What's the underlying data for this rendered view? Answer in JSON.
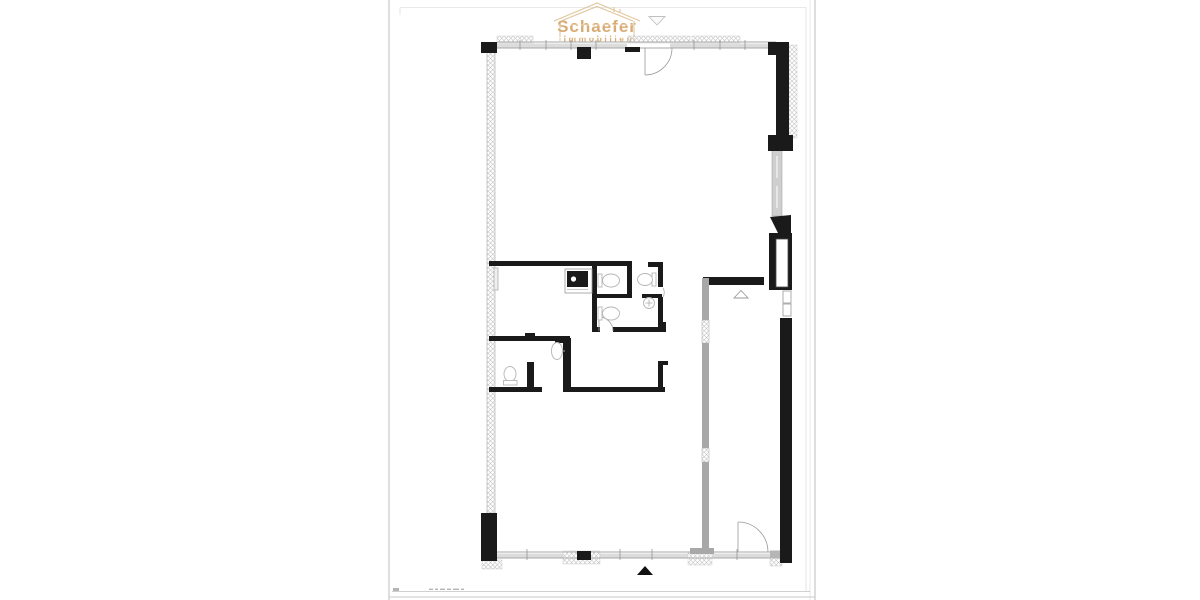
{
  "page": {
    "background": "#ffffff"
  },
  "sheet": {
    "edge_color": "#c9c9c9",
    "frame_color": "#dedede",
    "footer_rule_color": "#c0c0c0"
  },
  "logo": {
    "title": "Schaefer",
    "subtitle": "Immobilien",
    "text_color": "#d8ab72",
    "house_outline_color": "#e0c69c",
    "pennant_icon": "down-triangle-outline",
    "pennant_color": "#c0c0c0"
  },
  "plan": {
    "type": "floor-plan",
    "colors": {
      "wall": "#1a1a1a",
      "light_wall": "#a8a8a8",
      "hatch_line": "#bfbfbf",
      "window_fill": "#dcdcdc",
      "window_line": "#8a8a8a",
      "fixture_line": "#b5b5b5",
      "door_line": "#9a9a9a",
      "north_arrow": "#111111"
    },
    "symbols": [
      "north-arrow",
      "door-swing",
      "toilet",
      "sink",
      "kitchen-unit",
      "window-band",
      "hatched-wall",
      "corridor-partition",
      "pillar"
    ]
  }
}
